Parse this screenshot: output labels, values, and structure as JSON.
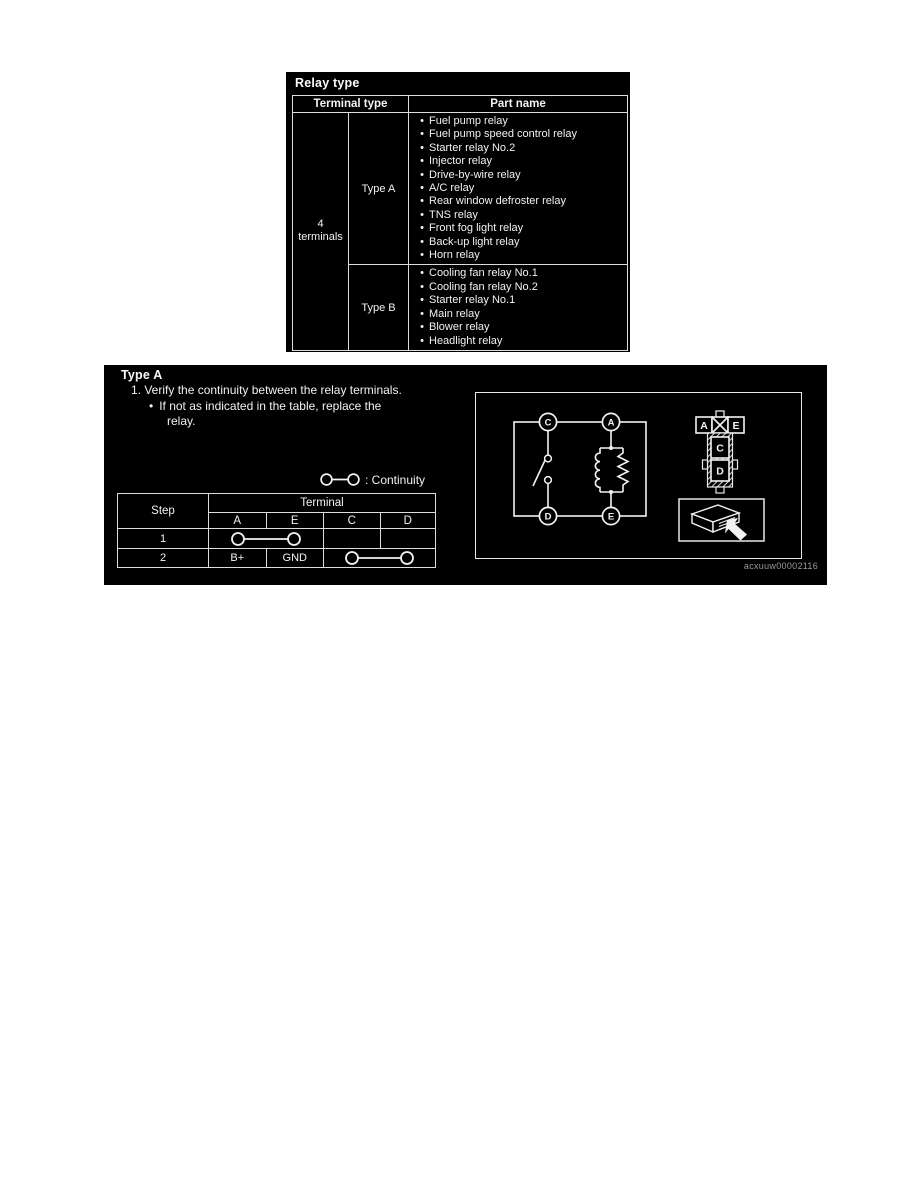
{
  "relay_type_panel": {
    "title": "Relay type",
    "headers": {
      "terminal_type": "Terminal type",
      "part_name": "Part name"
    },
    "terminal_count_line1": "4",
    "terminal_count_line2": "terminals",
    "type_a_label": "Type A",
    "type_b_label": "Type B",
    "type_a_parts": [
      "Fuel pump relay",
      "Fuel pump speed control relay",
      "Starter relay No.2",
      "Injector relay",
      "Drive-by-wire relay",
      "A/C relay",
      "Rear window defroster relay",
      "TNS relay",
      "Front fog light relay",
      "Back-up light relay",
      "Horn relay"
    ],
    "type_b_parts": [
      "Cooling fan relay No.1",
      "Cooling fan relay No.2",
      "Starter relay No.1",
      "Main relay",
      "Blower relay",
      "Headlight relay"
    ]
  },
  "type_a_panel": {
    "title": "Type A",
    "instruction": "1. Verify the continuity between the relay terminals.",
    "bullet": "If not as indicated in the table, replace the",
    "bullet_cont": "relay.",
    "legend_label": ": Continuity",
    "step_table": {
      "step_header": "Step",
      "terminal_header": "Terminal",
      "columns": [
        "A",
        "E",
        "C",
        "D"
      ],
      "row1_step": "1",
      "row2_step": "2",
      "row2_a": "B+",
      "row2_e": "GND"
    },
    "diagram": {
      "circuit_terminals": {
        "top_left": "C",
        "top_right": "A",
        "bottom_left": "D",
        "bottom_right": "E"
      },
      "connector": {
        "left": "A",
        "right": "E",
        "mid_top": "C",
        "mid_bottom": "D"
      },
      "figure_id": "acxuuw00002116"
    }
  }
}
